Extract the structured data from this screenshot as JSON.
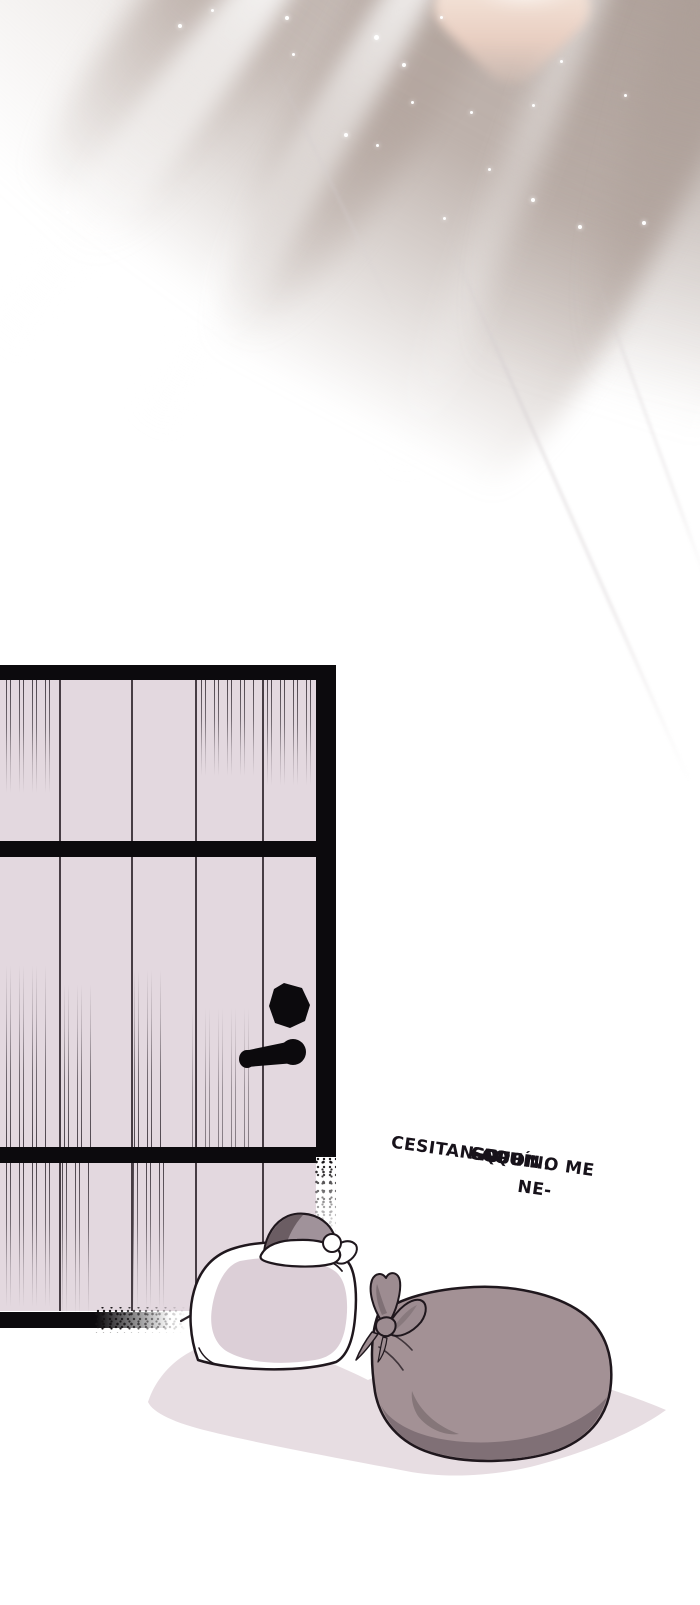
{
  "page": {
    "width": 700,
    "height": 1605,
    "background": "#ffffff"
  },
  "dialogue": {
    "line1_prefix": "SUPON",
    "line1_struck": "GO",
    "line1_suffix": " QUE NO ME NE-",
    "line2": "CESITAN AQUÍ..."
  },
  "door": {
    "plank_count": 5
  },
  "colors": {
    "page-bg": "#ffffff",
    "ink": "#17121a",
    "door-fill": "#e3d8df",
    "door-frame": "#0c0a0d",
    "plank-line": "#352c33",
    "scratch": "#2a222a",
    "taupe": "#b3a59e",
    "taupe-light": "#cbbfb8",
    "peach": "#e9cfc2",
    "white-sack-shade": "#dccfd7",
    "gray-sack": "#a39195",
    "gray-sack-dark": "#7d6e73",
    "gray-sack-fold": "#857679",
    "bow": "#9d8c91",
    "bow-dark": "#7f7075",
    "hat-mid": "#a0929a",
    "hat-dark": "#6b5d63",
    "outline": "#1f171d",
    "floor-shadow": "#e7dde2"
  },
  "sparkles": [
    {
      "x": 178,
      "y": 24,
      "s": 4
    },
    {
      "x": 211,
      "y": 9,
      "s": 3
    },
    {
      "x": 285,
      "y": 16,
      "s": 4
    },
    {
      "x": 374,
      "y": 35,
      "s": 5
    },
    {
      "x": 292,
      "y": 53,
      "s": 3
    },
    {
      "x": 402,
      "y": 63,
      "s": 4
    },
    {
      "x": 440,
      "y": 16,
      "s": 3
    },
    {
      "x": 344,
      "y": 133,
      "s": 4
    },
    {
      "x": 376,
      "y": 144,
      "s": 3
    },
    {
      "x": 470,
      "y": 111,
      "s": 3
    },
    {
      "x": 411,
      "y": 101,
      "s": 3
    },
    {
      "x": 532,
      "y": 104,
      "s": 3
    },
    {
      "x": 531,
      "y": 198,
      "s": 4
    },
    {
      "x": 578,
      "y": 225,
      "s": 4
    },
    {
      "x": 642,
      "y": 221,
      "s": 4
    },
    {
      "x": 443,
      "y": 217,
      "s": 3
    },
    {
      "x": 66,
      "y": 211,
      "s": 3
    },
    {
      "x": 560,
      "y": 60,
      "s": 3
    },
    {
      "x": 624,
      "y": 94,
      "s": 3
    },
    {
      "x": 488,
      "y": 168,
      "s": 3
    }
  ]
}
